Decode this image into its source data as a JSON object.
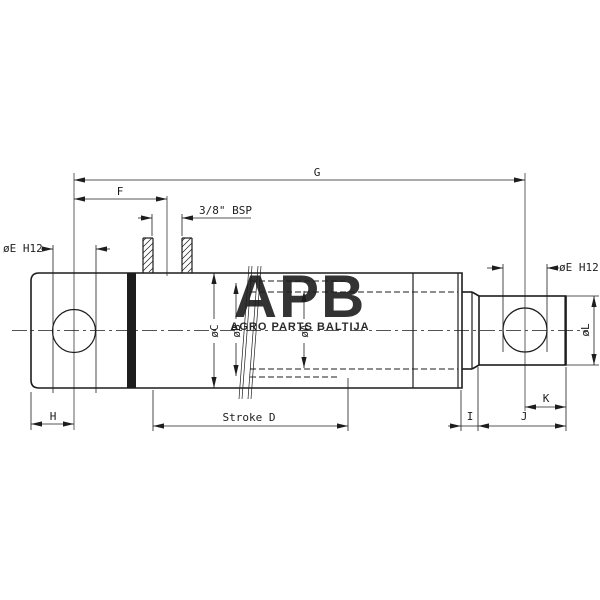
{
  "colors": {
    "background": "#ffffff",
    "line": "#1d1d1d",
    "watermark_logo": "#b8b8b8",
    "watermark_subtitle": "#afafaf"
  },
  "watermark": {
    "logo": "APB",
    "subtitle": "AGRO PARTS BALTIJA"
  },
  "labels": {
    "g": "G",
    "f": "F",
    "port": "3/8\" BSP",
    "e_left": "øE H12",
    "e_right": "øE H12",
    "c": "øC",
    "b": "øB",
    "a": "øA",
    "stroke_d": "Stroke D",
    "h": "H",
    "i": "I",
    "j": "J",
    "k": "K",
    "l": "øL"
  }
}
